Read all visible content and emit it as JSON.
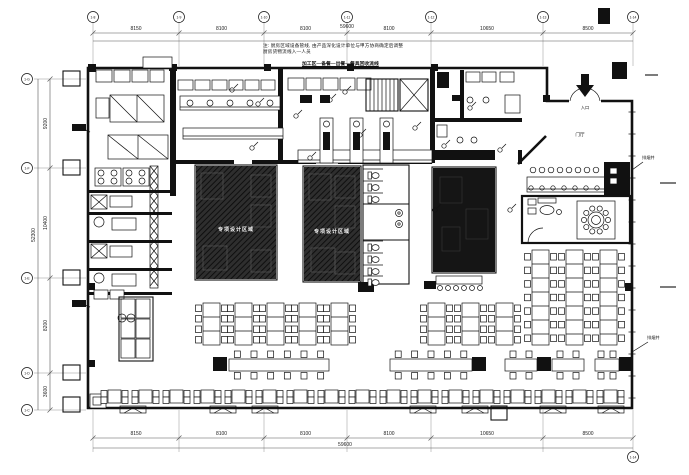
{
  "notes": {
    "line1": "注: 厨房区域设备管线, 由产品深化设计单位与甲方协商确定后调整",
    "line2": "厨房货物流线入—人员",
    "flow": "加工区—备餐—出餐—餐具回收流线"
  },
  "rooms": {
    "special_a": "专项设计区域",
    "special_b": "专项设计区域",
    "entrance_hall": "门厅"
  },
  "annotations": {
    "entry": "入口",
    "right_upper": "排烟井",
    "right_lower": "排烟井"
  },
  "dimensions": {
    "top": {
      "xs": [
        93,
        179,
        264,
        347,
        431,
        543,
        633
      ],
      "labels": [
        "8150",
        "8100",
        "8100",
        "8100",
        "10650",
        "8500"
      ],
      "total": "59600",
      "bubbles": [
        "1-8",
        "1-9",
        "1-10",
        "1-11",
        "1-12",
        "1-13",
        "1-14"
      ]
    },
    "bottom": {
      "xs": [
        93,
        179,
        264,
        347,
        431,
        543,
        633
      ],
      "labels": [
        "8150",
        "8100",
        "8100",
        "8100",
        "10650",
        "8500"
      ],
      "total": "59600",
      "bubble": "1-14"
    },
    "left": {
      "ys": [
        79,
        168,
        278,
        373,
        410
      ],
      "labels": [
        "9200",
        "10400",
        "8200",
        "3600"
      ],
      "total": "52300",
      "bubbles": [
        "1-G",
        "1-F",
        "1-E",
        "1-D",
        "1-C"
      ]
    }
  },
  "plan": {
    "outer": "M88,68 L547,68 L547,101 L632,101 L632,408 L88,408 Z",
    "interior_walls": [
      [
        170,
        68,
        6,
        128
      ],
      [
        278,
        68,
        5,
        95
      ],
      [
        430,
        68,
        5,
        95
      ],
      [
        460,
        70,
        4,
        50
      ],
      [
        430,
        118,
        92,
        4
      ],
      [
        88,
        190,
        84,
        3
      ],
      [
        88,
        212,
        84,
        3
      ],
      [
        88,
        240,
        84,
        3
      ],
      [
        88,
        268,
        84,
        3
      ],
      [
        88,
        292,
        84,
        3
      ],
      [
        172,
        160,
        62,
        4
      ],
      [
        252,
        160,
        64,
        4
      ],
      [
        338,
        160,
        94,
        4
      ],
      [
        518,
        150,
        4,
        14
      ]
    ],
    "diag_walls": [
      [
        518,
        164,
        546,
        136
      ]
    ],
    "shaft": [
      150,
      166,
      8,
      122
    ],
    "x_tables": [
      [
        110,
        95,
        54,
        27
      ],
      [
        108,
        135,
        60,
        24
      ]
    ],
    "x_boxes": [
      [
        370,
        151,
        28,
        11
      ],
      [
        91,
        195,
        16,
        14
      ],
      [
        91,
        244,
        16,
        14
      ]
    ],
    "equip_boxes": [
      [
        96,
        70,
        16,
        12
      ],
      [
        114,
        70,
        16,
        12
      ],
      [
        132,
        70,
        16,
        12
      ],
      [
        150,
        70,
        14,
        12
      ],
      [
        178,
        80,
        15,
        10
      ],
      [
        195,
        80,
        15,
        10
      ],
      [
        212,
        80,
        15,
        10
      ],
      [
        229,
        80,
        14,
        10
      ],
      [
        245,
        80,
        14,
        10
      ],
      [
        261,
        80,
        14,
        10
      ],
      [
        288,
        78,
        16,
        12
      ],
      [
        306,
        78,
        15,
        12
      ],
      [
        323,
        78,
        15,
        12
      ],
      [
        340,
        78,
        15,
        12
      ],
      [
        357,
        78,
        14,
        12
      ],
      [
        466,
        72,
        14,
        10
      ],
      [
        482,
        72,
        14,
        10
      ],
      [
        500,
        72,
        14,
        10
      ],
      [
        505,
        95,
        15,
        18
      ],
      [
        437,
        125,
        10,
        12
      ],
      [
        96,
        98,
        13,
        20
      ],
      [
        94,
        290,
        14,
        9
      ],
      [
        110,
        290,
        14,
        9
      ],
      [
        143,
        57,
        29,
        11
      ],
      [
        110,
        196,
        22,
        11
      ],
      [
        110,
        246,
        22,
        11
      ],
      [
        112,
        218,
        24,
        12
      ],
      [
        112,
        274,
        24,
        12
      ],
      [
        90,
        394,
        16,
        14
      ],
      [
        93,
        397,
        8,
        8
      ]
    ],
    "stoves": [
      [
        95,
        168,
        26,
        18
      ],
      [
        123,
        168,
        26,
        18
      ]
    ],
    "counters": [
      [
        180,
        96,
        100,
        14
      ],
      [
        183,
        128,
        100,
        11
      ],
      [
        298,
        150,
        134,
        13
      ],
      [
        527,
        177,
        80,
        15
      ]
    ],
    "vert_counters": [
      [
        320,
        118,
        13,
        45
      ],
      [
        350,
        118,
        13,
        45
      ],
      [
        380,
        118,
        13,
        45
      ]
    ],
    "dark_rects": [
      [
        433,
        150,
        62,
        10
      ],
      [
        300,
        95,
        12,
        8
      ],
      [
        320,
        95,
        10,
        8
      ],
      [
        437,
        72,
        12,
        16
      ],
      [
        452,
        95,
        10,
        6
      ],
      [
        612,
        62,
        15,
        17
      ],
      [
        598,
        8,
        12,
        16
      ],
      [
        358,
        282,
        16,
        10
      ],
      [
        424,
        281,
        12,
        8
      ],
      [
        535,
        279,
        12,
        8
      ],
      [
        72,
        124,
        14,
        7
      ],
      [
        72,
        300,
        14,
        7
      ],
      [
        604,
        162,
        26,
        34
      ]
    ],
    "white_insets": [
      [
        610,
        168,
        7,
        6
      ],
      [
        610,
        178,
        7,
        6
      ]
    ],
    "circles": [
      [
        190,
        103,
        3
      ],
      [
        210,
        103,
        3
      ],
      [
        230,
        103,
        3
      ],
      [
        250,
        103,
        3
      ],
      [
        270,
        103,
        3
      ],
      [
        470,
        100,
        3
      ],
      [
        486,
        100,
        3
      ],
      [
        460,
        140,
        3
      ],
      [
        474,
        140,
        3
      ],
      [
        122,
        318,
        4
      ],
      [
        131,
        318,
        4
      ],
      [
        99,
        222,
        5
      ],
      [
        99,
        278,
        5
      ]
    ],
    "stairs": [
      366,
      79,
      32,
      32
    ],
    "elevator": [
      400,
      79,
      28,
      32
    ],
    "dark_rooms": [
      {
        "r": [
          195,
          165,
          82,
          115
        ],
        "kind": "hatch"
      },
      {
        "r": [
          303,
          166,
          58,
          116
        ],
        "kind": "hatch"
      },
      {
        "r": [
          432,
          167,
          64,
          106
        ],
        "kind": "solid"
      }
    ],
    "room_c_counter": {
      "rect": [
        436,
        276,
        46,
        8
      ],
      "stools_y": 288,
      "stool_x0": 440,
      "stool_n": 6,
      "stool_dx": 8
    },
    "toilet_room": {
      "rect": [
        363,
        165,
        46,
        119
      ],
      "dividers": [
        204,
        240
      ],
      "toilets_top": [
        172,
        184,
        196
      ],
      "toilets_bottom": [
        244,
        256,
        268,
        279
      ],
      "tx": 368,
      "sinks": [
        [
          399,
          213
        ],
        [
          399,
          224
        ]
      ]
    },
    "vip": {
      "room": [
        522,
        196,
        108,
        47
      ],
      "mat": [
        577,
        201,
        38,
        38
      ],
      "table": [
        596,
        220,
        8
      ],
      "chair_n": 10,
      "chair_ring": 12,
      "stools": {
        "x0": 533,
        "dx": 9,
        "n": 8,
        "y": 170
      },
      "face_circles": {
        "x0": 531,
        "dx": 11,
        "n": 7,
        "y": 188
      },
      "lounge": {
        "arm": [
          [
            528,
            199,
            8,
            6
          ],
          [
            528,
            208,
            8,
            6
          ]
        ],
        "bench": [
          538,
          198,
          18,
          5
        ],
        "oval": [
          547,
          210,
          7,
          4.5
        ],
        "dot": [
          559,
          212,
          2.5
        ]
      },
      "door_arc": "M528,243 A15,15 0 0 1 543,228"
    },
    "row1": {
      "tw": 17,
      "short": {
        "y": 303,
        "h": 42,
        "xs": [
          203,
          235,
          267,
          299,
          331,
          428,
          462,
          496
        ],
        "chairs": 4
      },
      "tall": {
        "y": 250,
        "h": 95,
        "xs": [
          532,
          566,
          600
        ],
        "chairs": 7
      }
    },
    "row2": {
      "y": 359,
      "h": 12,
      "cap_y": 357,
      "cap_s": 14,
      "caps": [
        213,
        472,
        537,
        619
      ],
      "tables": [
        [
          229,
          100,
          6
        ],
        [
          390,
          82,
          5
        ],
        [
          505,
          32,
          2
        ],
        [
          552,
          32,
          2
        ],
        [
          595,
          24,
          2
        ]
      ]
    },
    "row3": {
      "y": 390,
      "size": 13,
      "start": 108,
      "count": 17,
      "step": 31
    },
    "benches": [
      [
        120,
        406
      ],
      [
        210,
        406
      ],
      [
        252,
        406
      ],
      [
        410,
        406
      ],
      [
        462,
        406
      ],
      [
        540,
        406
      ],
      [
        598,
        406
      ]
    ],
    "bench_w": 26,
    "bench_h": 7,
    "below_box": [
      491,
      406,
      16,
      14
    ],
    "shelf": {
      "rect": [
        119,
        297,
        34,
        64
      ],
      "cols": 2,
      "rows": 3
    },
    "columns": [
      [
        264,
        64,
        7,
        7
      ],
      [
        347,
        64,
        7,
        7
      ],
      [
        431,
        64,
        7,
        7
      ],
      [
        543,
        95,
        7,
        7
      ],
      [
        169,
        64,
        8,
        7
      ],
      [
        88,
        64,
        8,
        8
      ],
      [
        625,
        283,
        8,
        8
      ],
      [
        625,
        360,
        8,
        8
      ],
      [
        88,
        283,
        7,
        7
      ],
      [
        88,
        360,
        7,
        7
      ]
    ],
    "callouts": [
      [
        232,
        90
      ],
      [
        258,
        104
      ],
      [
        296,
        116
      ],
      [
        330,
        100
      ],
      [
        360,
        135
      ],
      [
        252,
        148
      ],
      [
        310,
        158
      ],
      [
        415,
        128
      ],
      [
        444,
        146
      ],
      [
        470,
        108
      ],
      [
        500,
        150
      ],
      [
        345,
        92
      ],
      [
        435,
        210
      ],
      [
        510,
        210
      ]
    ],
    "leader_lines": [
      [
        79,
        127,
        90,
        132
      ],
      [
        79,
        303,
        90,
        307
      ],
      [
        643,
        162,
        632,
        170
      ],
      [
        648,
        342,
        632,
        352
      ]
    ],
    "right_dashes": [
      [
        660,
        183,
        676,
        183
      ],
      [
        660,
        287,
        676,
        287
      ],
      [
        645,
        75,
        658,
        75
      ]
    ],
    "window_ticks": {
      "x1": 628.5,
      "x2": 635.5,
      "y0": 112,
      "y1": 402,
      "step": 22
    },
    "door": {
      "gap": [
        569,
        97.5,
        32,
        8
      ],
      "arc1": "M570,101 A15,15 0 0 1 585,88",
      "arc2": "M600,101 A15,15 0 0 0 585,88",
      "arrow": "581,74 589,74 589,85 594,85 585,97 576,85 581,85",
      "entry_xy": [
        585,
        109
      ]
    },
    "ann_right_upper_xy": [
      642,
      159
    ],
    "ann_right_lower_xy": [
      647,
      339
    ]
  }
}
